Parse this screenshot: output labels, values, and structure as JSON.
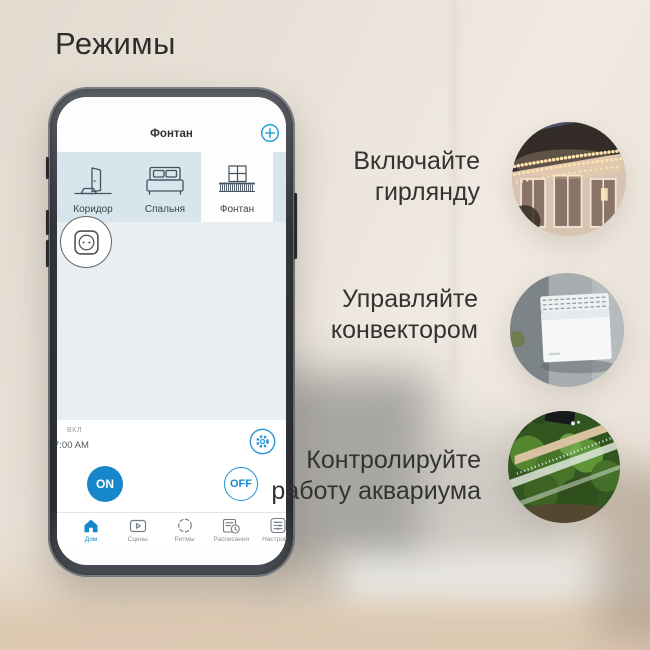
{
  "title": "Режимы",
  "phone": {
    "app": {
      "header": {
        "title": "Фонтан"
      },
      "tabs": [
        {
          "label": "Коридор",
          "icon": "door-icon"
        },
        {
          "label": "Спальня",
          "icon": "bed-icon"
        },
        {
          "label": "Фонтан",
          "icon": "balcony-icon"
        }
      ],
      "device_button": {
        "icon": "socket-icon"
      },
      "control": {
        "status": "ВКЛ",
        "time": "7:00 AM",
        "on": "ON",
        "off": "OFF"
      },
      "nav": [
        {
          "label": "Дом",
          "icon": "home-icon",
          "active": true
        },
        {
          "label": "Сцены",
          "icon": "scenes-icon",
          "active": false
        },
        {
          "label": "Ритмы",
          "icon": "rhythms-icon",
          "active": false
        },
        {
          "label": "Расписания",
          "icon": "schedules-icon",
          "active": false
        },
        {
          "label": "Настройки",
          "icon": "settings-icon",
          "active": false
        }
      ]
    }
  },
  "features": [
    {
      "line1": "Включайте",
      "line2": "гирлянду",
      "image": "garland-lights-photo"
    },
    {
      "line1": "Управляйте",
      "line2": "конвектором",
      "image": "convector-heater-photo"
    },
    {
      "line1": "Контролируйте",
      "line2": "работу аквариума",
      "image": "aquarium-photo"
    }
  ],
  "colors": {
    "accent_blue": "#1787cb",
    "tab_bar_bg": "#d8e5ec",
    "app_main_bg": "#e9eef2",
    "background_beige": "#e9e2d8"
  }
}
